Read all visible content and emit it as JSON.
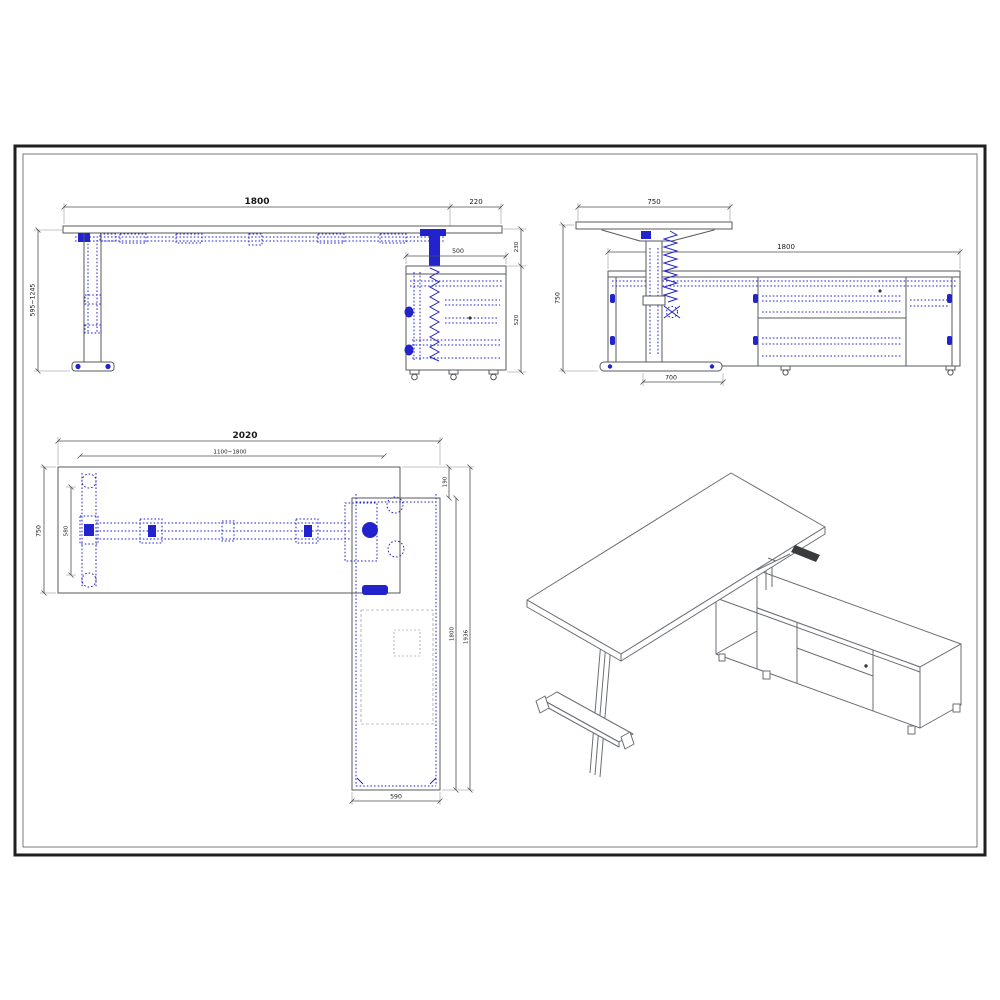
{
  "colors": {
    "drawing_line": "#55585e",
    "hardware_blue": "#2323cd",
    "dimension_line": "#4c4f54",
    "text": "#17181a",
    "border": "#1f1f1f",
    "background": "#ffffff"
  },
  "front_view": {
    "dims": {
      "width": "1800",
      "overhang": "220",
      "height_range": "595~1245",
      "cabinet_width": "500",
      "top_gap": "230",
      "cabinet_height": "520"
    }
  },
  "side_view": {
    "dims": {
      "desk_depth": "750",
      "cabinet_length": "1800",
      "height": "750",
      "foot_width": "700"
    }
  },
  "plan_view": {
    "dims": {
      "overall_width": "2020",
      "frame_range": "1100~1800",
      "desk_depth": "750",
      "foot_span": "580",
      "top_gap": "190",
      "cabinet_run": "1800",
      "overall_depth": "1936",
      "cabinet_width": "590"
    }
  }
}
